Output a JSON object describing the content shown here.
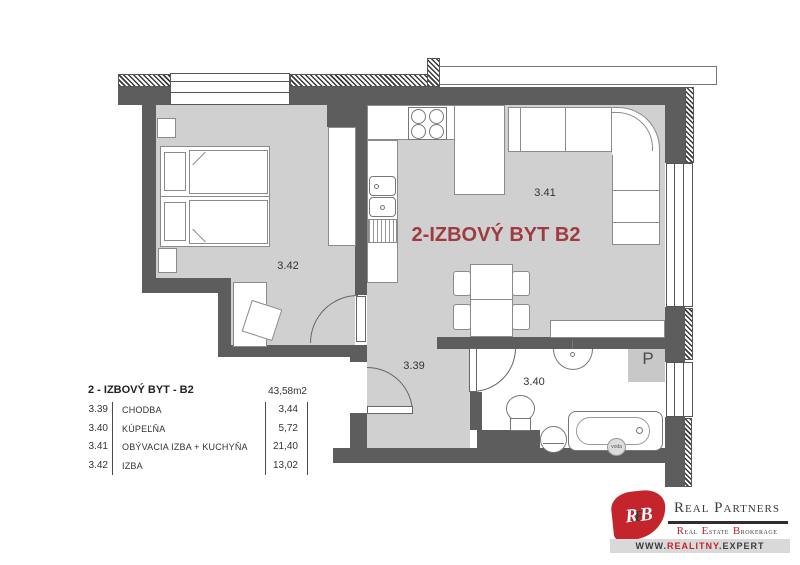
{
  "title": {
    "text": "2-IZBOVÝ BYT B2"
  },
  "rooms": {
    "hallway": {
      "number": "3.39"
    },
    "bathroom": {
      "number": "3.40"
    },
    "living": {
      "number": "3.41"
    },
    "bedroom": {
      "number": "3.42"
    }
  },
  "annotations": {
    "parking_p": "P",
    "water": "voda"
  },
  "legend": {
    "header": "2 - IZBOVÝ BYT - B2",
    "total_area": "43,58m2",
    "rows": [
      {
        "number": "3.39",
        "name": "CHODBA",
        "area": "3,44"
      },
      {
        "number": "3.40",
        "name": "KÚPEĽŇA",
        "area": "5,72"
      },
      {
        "number": "3.41",
        "name": "OBÝVACIA IZBA + KUCHYŇA",
        "area": "21,40"
      },
      {
        "number": "3.42",
        "name": "IZBA",
        "area": "13,02"
      }
    ]
  },
  "logo": {
    "monogram": [
      "R",
      "E",
      "B"
    ],
    "name": "Real Partners",
    "tagline_words": [
      "Real",
      "Estate",
      "Brokerage"
    ],
    "website": {
      "prefix": "WWW.",
      "domain": "REALITNY",
      "suffix": ".EXPERT"
    }
  },
  "colors": {
    "wall": "#5d5d5d",
    "floor": "#d0d0d0",
    "title_red": "#9e3b40",
    "logo_red": "#c4242b"
  }
}
